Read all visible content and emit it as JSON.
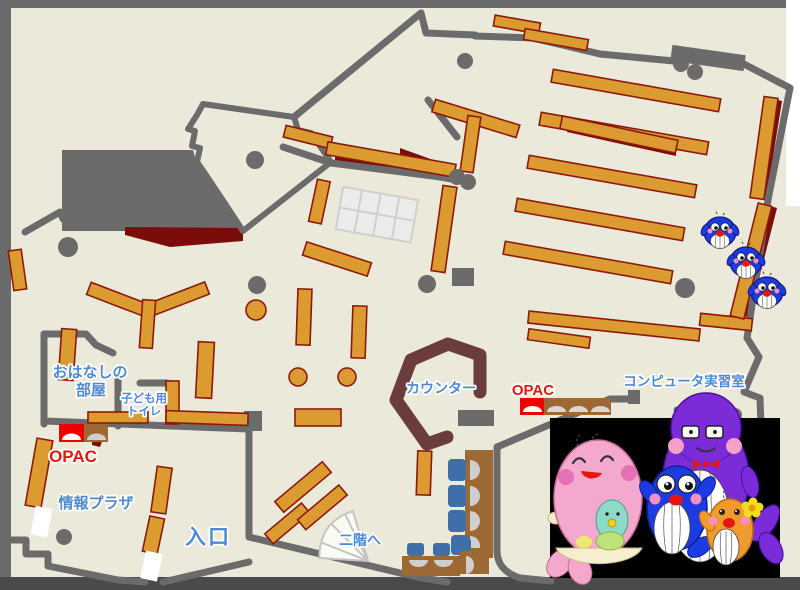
{
  "map": {
    "labels": {
      "storytelling_room_line1": "おはなしの",
      "storytelling_room_line2": "部屋",
      "kids_toilet_line1": "子ども用",
      "kids_toilet_line2": "トイレ",
      "opac_left": "OPAC",
      "opac_right": "OPAC",
      "info_plaza": "情報プラザ",
      "entrance": "入口",
      "counter": "カウンター",
      "computer_room": "コンピュータ実習室",
      "to_second_floor": "二階へ"
    },
    "colors": {
      "floor": "#EBE9D9",
      "frame": "#6B6B6B",
      "frame_bottom": "#4A4A4A",
      "wall": "#6B6B6B",
      "shelf": "#DC9B30",
      "shelf_border": "#8C1A0C",
      "dark_red": "#7A0C0C",
      "counter": "#6B3C3C",
      "desk_brown": "#9C6834",
      "chair_blue": "#3F6FA8",
      "monitor_gray": "#CFCFCF",
      "table_white": "#ECECEA",
      "label_blue": "#4E8AD2",
      "label_red": "#E3170D",
      "opac_red": "#EE0000",
      "mascot_pink": "#F5A8CE",
      "mascot_blue": "#1C3BE2",
      "mascot_purple": "#7B2BD8",
      "mascot_orange": "#F19A2E",
      "baby_green": "#8FD9C9",
      "photo_bg": "#000000"
    }
  }
}
